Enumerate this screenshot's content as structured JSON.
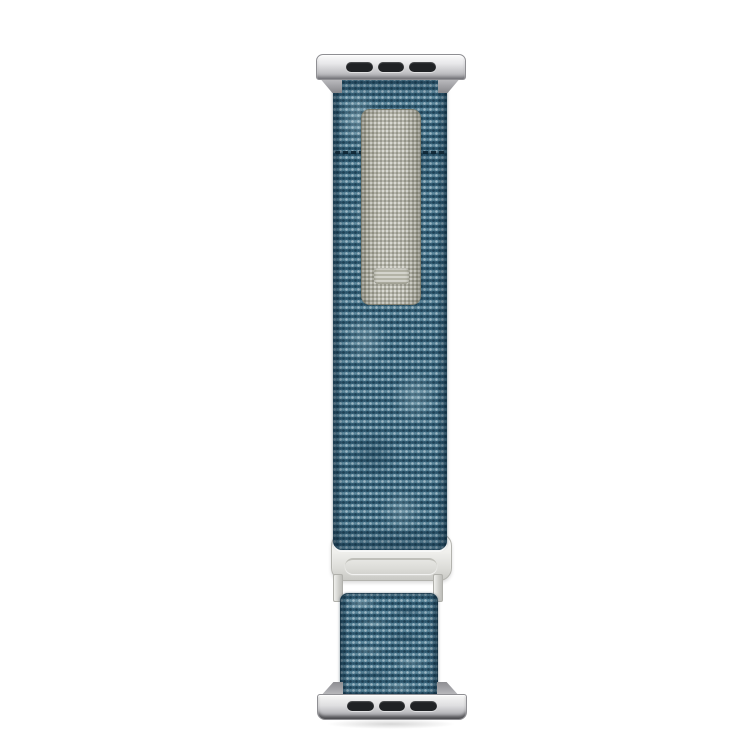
{
  "scene": {
    "type": "product-photo",
    "subject": "blue heathered fabric smartwatch band with silver lug adapters, gray hook-and-loop patch and silver G-hook buckle on white background"
  },
  "colors": {
    "background": "#ffffff",
    "fabric_base": "#3f6d85",
    "fabric_dark": "#2a4f66",
    "fabric_light": "#9db9c4",
    "patch_base": "#a9a99c",
    "patch_light": "#c9c9bc",
    "label_tab": "#c2c2b6",
    "metal_light": "#f5f5f4",
    "metal_mid": "#c6c6c9",
    "metal_dark": "#8e8e92",
    "slot_color": "#202225",
    "stitch_color": "#16303f"
  }
}
